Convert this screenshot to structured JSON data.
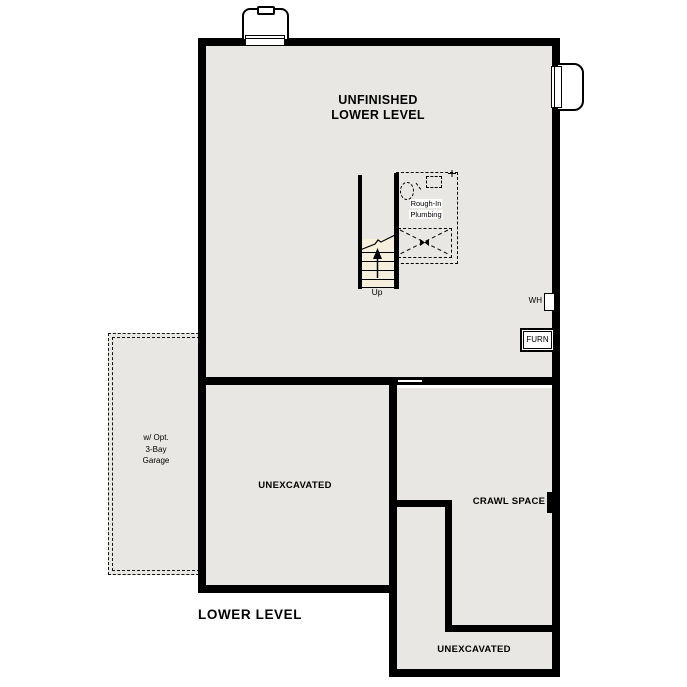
{
  "plan": {
    "sheet_title": "LOWER LEVEL",
    "main_room": {
      "label_line1": "UNFINISHED",
      "label_line2": "LOWER LEVEL"
    },
    "unexcavated_left_label": "UNEXCAVATED",
    "crawl_space_label": "CRAWL SPACE",
    "unexcavated_bottom_label": "UNEXCAVATED",
    "garage": {
      "line1": "w/ Opt.",
      "line2": "3-Bay",
      "line3": "Garage"
    },
    "stairs": {
      "direction_label": "Up"
    },
    "plumbing": {
      "line1": "Rough-In",
      "line2": "Plumbing"
    },
    "water_heater_label": "WH",
    "furnace_label": "FURN",
    "colors": {
      "wall": "#000000",
      "floor_fill": "#e8e7e3",
      "stair_fill": "#f6efdc",
      "background": "#ffffff"
    }
  }
}
